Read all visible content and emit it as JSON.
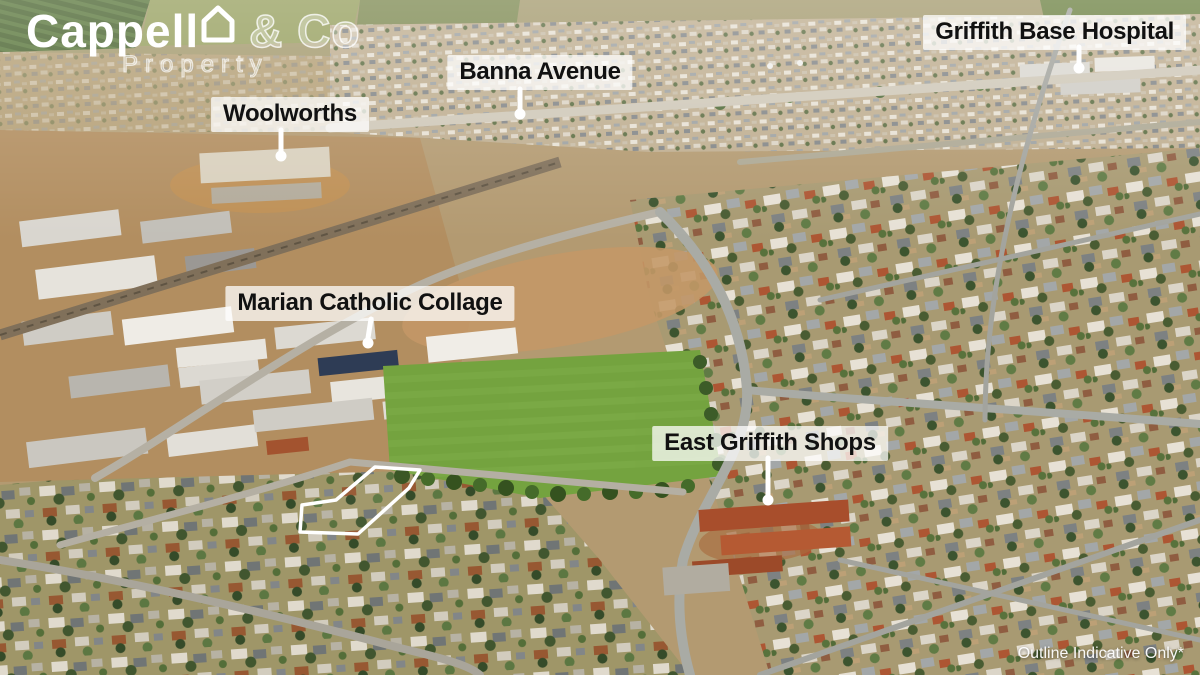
{
  "brand": {
    "text_before_icon": "Cappell",
    "icon_letter": "o",
    "text_after_icon": "& Co",
    "subtitle": "Property"
  },
  "labels": {
    "woolworths": "Woolworths",
    "banna_avenue": "Banna Avenue",
    "hospital": "Griffith Base Hospital",
    "college": "Marian Catholic Collage",
    "shops": "East Griffith Shops"
  },
  "disclaimer": "Outline Indicative Only*",
  "colors": {
    "label_bg": "rgba(255,255,255,0.74)",
    "label_text": "#111111",
    "pointer_white": "#ffffff",
    "property_outline": "#ffffff",
    "oval_green": "#74a33f"
  }
}
